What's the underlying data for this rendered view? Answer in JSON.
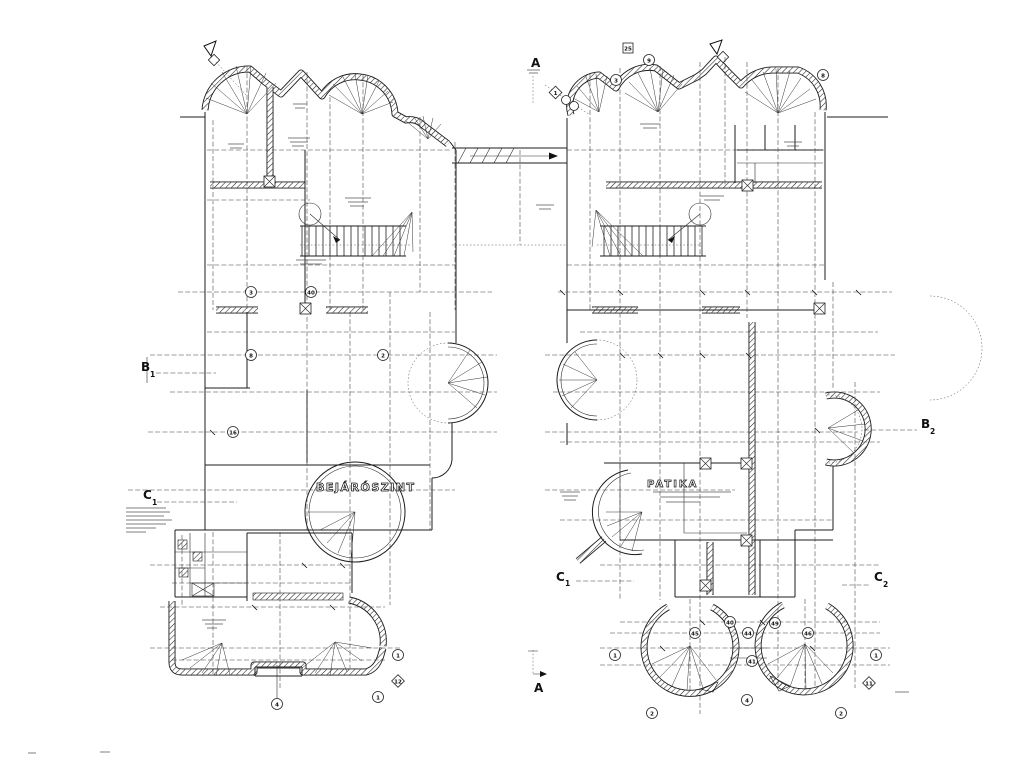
{
  "labels": {
    "left_room": "BEJÁRÓSZINT",
    "right_room": "PATIKA"
  },
  "markers": {
    "a_top": "A",
    "a_bottom": "A",
    "b1_main": "B",
    "b1_sub": "1",
    "b2_main": "B",
    "b2_sub": "2",
    "c1_left_main": "C",
    "c1_left_sub": "1",
    "c1_bottom_main": "C",
    "c1_bottom_sub": "1",
    "c2_main": "C",
    "c2_sub": "2"
  },
  "bubbles": [
    "3",
    "40",
    "8",
    "2",
    "16",
    "9",
    "3",
    "8",
    "1",
    "25",
    "40",
    "45",
    "44",
    "49",
    "46",
    "41",
    "1",
    "2",
    "4",
    "2",
    "1",
    "1",
    "1",
    "4",
    "12",
    "11"
  ],
  "colors": {
    "ink": "#1c1c1c",
    "paper": "#ffffff"
  }
}
